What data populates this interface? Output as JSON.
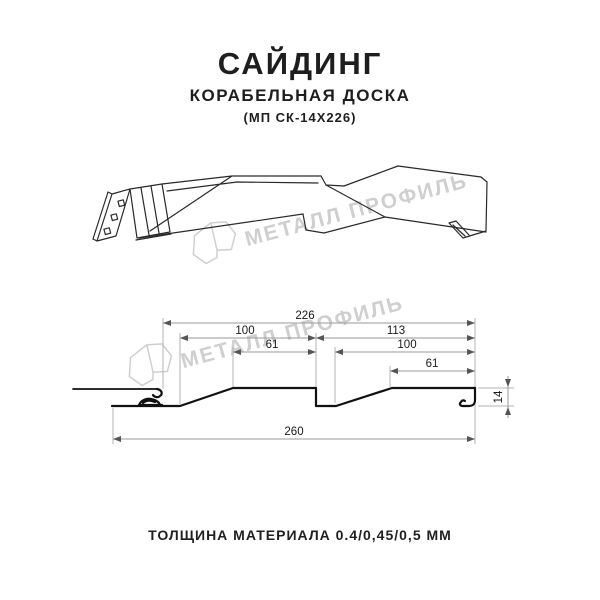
{
  "header": {
    "title": "САЙДИНГ",
    "subtitle": "КОРАБЕЛЬНАЯ ДОСКА",
    "model": "(МП СК-14Х226)"
  },
  "watermark": {
    "text": "МЕТАЛЛ ПРОФИЛЬ",
    "logo": "metall-profil-crystal-logo",
    "color": "#cfcfcf"
  },
  "section_dimensions": {
    "overall_width": "226",
    "left_board_width": "100",
    "left_flat_width": "61",
    "right_board_width": "113",
    "right_flat_width": "100",
    "right_inner_flat_width": "61",
    "total_width": "260",
    "profile_height": "14"
  },
  "footer": {
    "text": "ТОЛЩИНА МАТЕРИАЛА 0.4/0,45/0,5 ММ"
  },
  "colors": {
    "profile_line": "#111111",
    "dimension_line": "#9a9a9a",
    "watermark": "#cfcfcf",
    "text": "#1e1e1e"
  }
}
